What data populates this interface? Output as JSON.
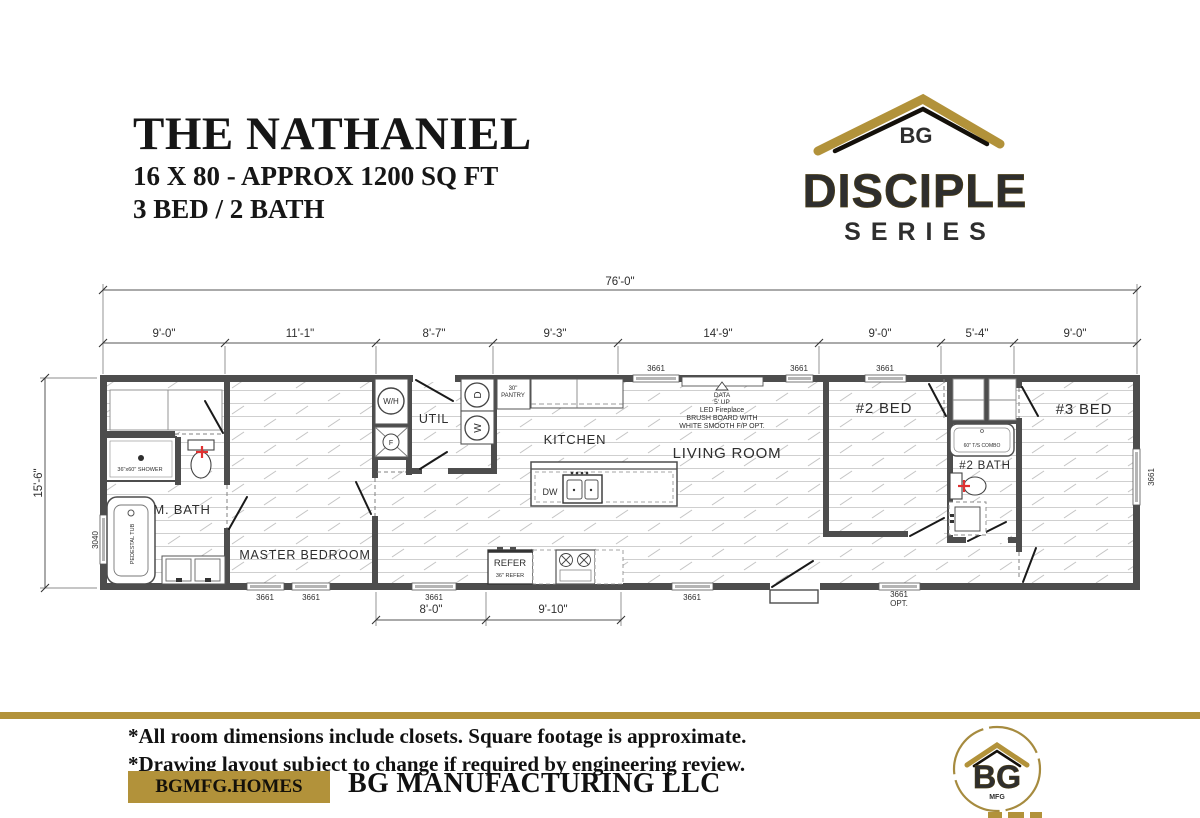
{
  "header": {
    "title": "THE NATHANIEL",
    "subtitle1": "16 X 80 - APPROX 1200 SQ FT",
    "subtitle2": "3 BED / 2 BATH"
  },
  "brand": {
    "bg": "BG",
    "series_name": "DISCIPLE",
    "series_word": "SERIES"
  },
  "colors": {
    "gold": "#b2923a",
    "gold_dark": "#8a6f25",
    "wall": "#4d4d4d",
    "accent_red": "#e03131",
    "ink": "#161616"
  },
  "plan": {
    "rooms": {
      "m_bath": "M. BATH",
      "master_bedroom": "MASTER BEDROOM",
      "util": "UTIL",
      "kitchen": "KITCHEN",
      "living_room": "LIVING ROOM",
      "bed2": "#2 BED",
      "bath2": "#2 BATH",
      "bed3": "#3 BED"
    },
    "fixtures": {
      "shower": "36\"x60\" SHOWER",
      "pedestal_tub": "PEDESTAL TUB",
      "water_heater": "W/H",
      "furnace": "F",
      "dryer": "D",
      "washer": "W",
      "pantry_line1": "30\"",
      "pantry_line2": "PANTRY",
      "dishwasher": "DW",
      "refer": "REFER",
      "refer_size": "36\" REFER",
      "tub_combo": "60\" T/S COMBO"
    },
    "fireplace_note": [
      "DATA",
      "5' UP",
      "LED Fireplace",
      "BRUSH BOARD WITH",
      "WHITE SMOOTH F/P OPT."
    ],
    "windows": {
      "std": "3661",
      "opt_line1": "3661",
      "opt_line2": "OPT.",
      "left": "3040"
    },
    "dims": {
      "overall_width": "76'-0\"",
      "overall_depth": "15'-6\"",
      "top_segments": [
        "9'-0\"",
        "11'-1\"",
        "8'-7\"",
        "9'-3\"",
        "14'-9\"",
        "9'-0\"",
        "5'-4\"",
        "9'-0\""
      ],
      "bottom_segments": [
        "8'-0\"",
        "9'-10\""
      ]
    }
  },
  "footer": {
    "note1": "*All room dimensions include closets. Square footage is approximate.",
    "note2": "*Drawing layout subject to change if required by engineering review.",
    "website": "BGMFG.HOMES",
    "company": "BG MANUFACTURING LLC",
    "logo_bg": "BG",
    "logo_mfg": "MFG"
  }
}
